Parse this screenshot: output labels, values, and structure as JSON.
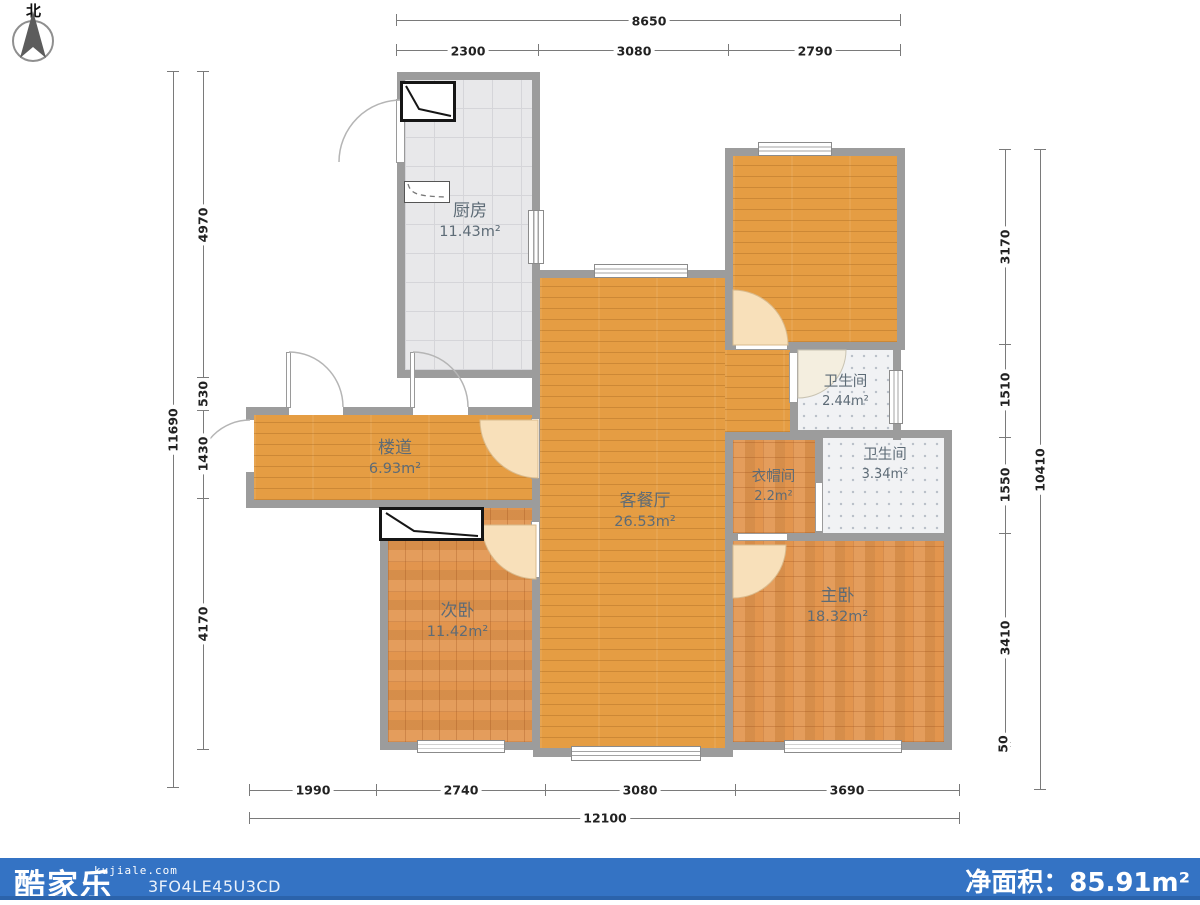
{
  "north_label": "北",
  "rooms": {
    "kitchen": {
      "name": "厨房",
      "area": "11.43m²"
    },
    "living": {
      "name": "客餐厅",
      "area": "26.53m²"
    },
    "corridor": {
      "name": "楼道",
      "area": "6.93m²"
    },
    "bath_small": {
      "name": "卫生间",
      "area": "2.44m²"
    },
    "cloakroom": {
      "name": "衣帽间",
      "area": "2.2m²"
    },
    "bath_large": {
      "name": "卫生间",
      "area": "3.34m²"
    },
    "bedroom_second": {
      "name": "次卧",
      "area": "11.42m²"
    },
    "bedroom_master": {
      "name": "主卧",
      "area": "18.32m²"
    }
  },
  "dimensions": {
    "top": {
      "total": "8650",
      "segments": [
        "2300",
        "3080",
        "2790"
      ]
    },
    "bottom": {
      "total": "12100",
      "segments": [
        "1990",
        "2740",
        "3080",
        "3690"
      ]
    },
    "left": {
      "total": "11690",
      "segments": [
        "4970",
        "530",
        "1430",
        "4170"
      ]
    },
    "right": {
      "total": "10410",
      "segments": [
        "3170",
        "1510",
        "1550",
        "3410",
        "50"
      ]
    }
  },
  "footer": {
    "brand": "酷家乐",
    "domain": "kujiale.com",
    "code": "3FO4LE45U3CD",
    "net_area_label": "净面积：",
    "net_area_value": "85.91m²"
  },
  "colors": {
    "accent_blue": "#3473c4",
    "wall": "#9c9c9c",
    "wood": "#e59d43",
    "wood_warm": "#e2954e"
  }
}
